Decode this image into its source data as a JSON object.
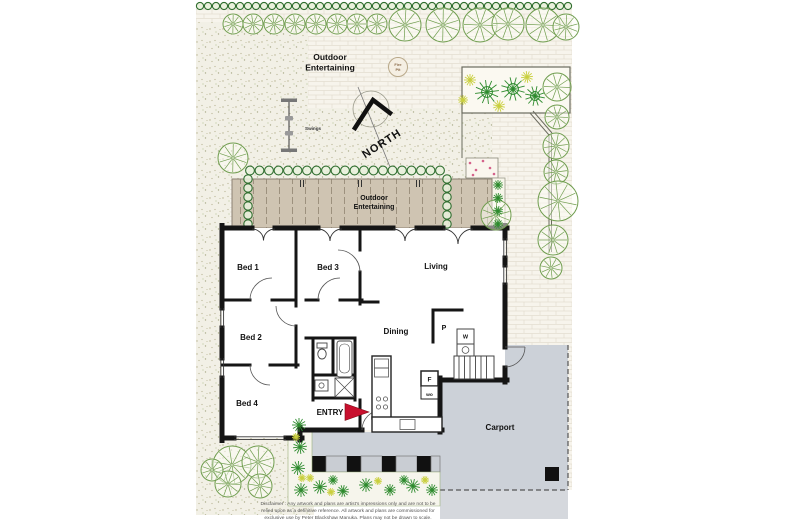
{
  "backyard": {
    "area_label_line1": "Outdoor",
    "area_label_line2": "Entertaining",
    "fire_pit_line1": "Fire",
    "fire_pit_line2": "Pit",
    "swings_label": "Swings",
    "north_label": "NORTH"
  },
  "deck": {
    "label_line1": "Outdoor",
    "label_line2": "Entertaining"
  },
  "rooms": {
    "bed1": "Bed 1",
    "bed3": "Bed 3",
    "living": "Living",
    "bed2": "Bed 2",
    "dining": "Dining",
    "bed4": "Bed 4",
    "entry": "ENTRY",
    "carport": "Carport"
  },
  "fixtures": {
    "pantry": "P",
    "fridge": "F",
    "wall_oven": "wo",
    "washer": "W"
  },
  "disclaimer": {
    "line1": "Disclaimer : Any artwork and plans are artist's impressions only and are not to be",
    "line2": "relied upon as a definitive reference. All artwork and plans are commissioned for",
    "line3": "exclusive use by Peter Blackshaw Manuka. Plans may not be drawn to scale."
  },
  "colors": {
    "paving": "#f7f4ec",
    "deck": "#cfc4b2",
    "carport": "#ccd1d8",
    "driveway": "#d5d8dd",
    "tree": "#6f9d4e",
    "shrub": "#2e8b2e",
    "yellow_plant": "#c9cf3e",
    "hedge": "#2f6e2f",
    "entry_arrow": "#c8102e",
    "wall": "#151515"
  }
}
